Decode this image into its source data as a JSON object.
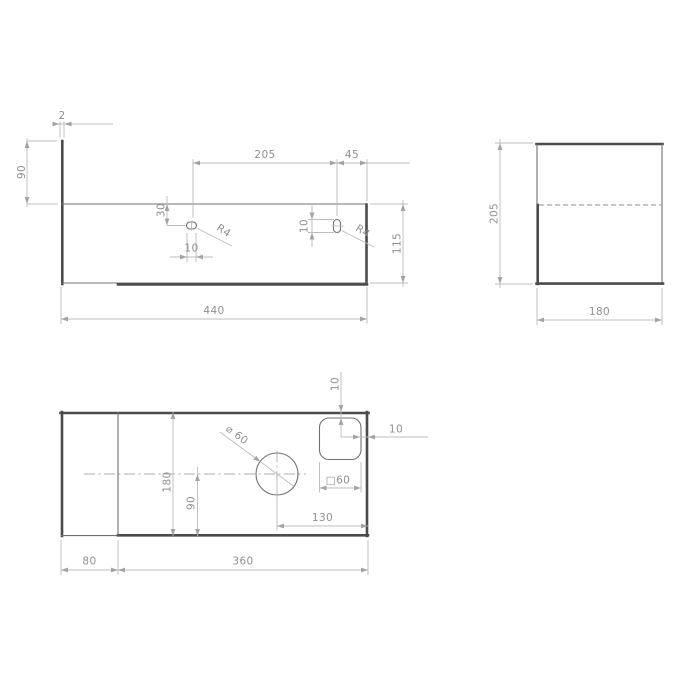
{
  "front": {
    "thickness": "2",
    "back_height": "90",
    "slot_spacing": "205",
    "slot_edge_offset": "45",
    "slot_top_offset": "30",
    "left_slot_length": "10",
    "left_slot_radius": "R4",
    "right_slot_length": "10",
    "right_slot_radius": "R4",
    "height": "115",
    "width": "440"
  },
  "side": {
    "height": "205",
    "depth": "180"
  },
  "plan": {
    "cutout_top_offset": "10",
    "cutout_side_offset": "10",
    "cutout_size": "□60",
    "hole_diameter": "⌀ 60",
    "hole_to_edge": "130",
    "hole_to_bottom": "90",
    "depth": "180",
    "return_width": "80",
    "body_width": "360"
  },
  "palette": {
    "line_dark": "#4b4b4b",
    "line_thin": "#707070",
    "line_dim": "#bcbcbc",
    "text": "#8f8f8f",
    "background": "#ffffff"
  }
}
